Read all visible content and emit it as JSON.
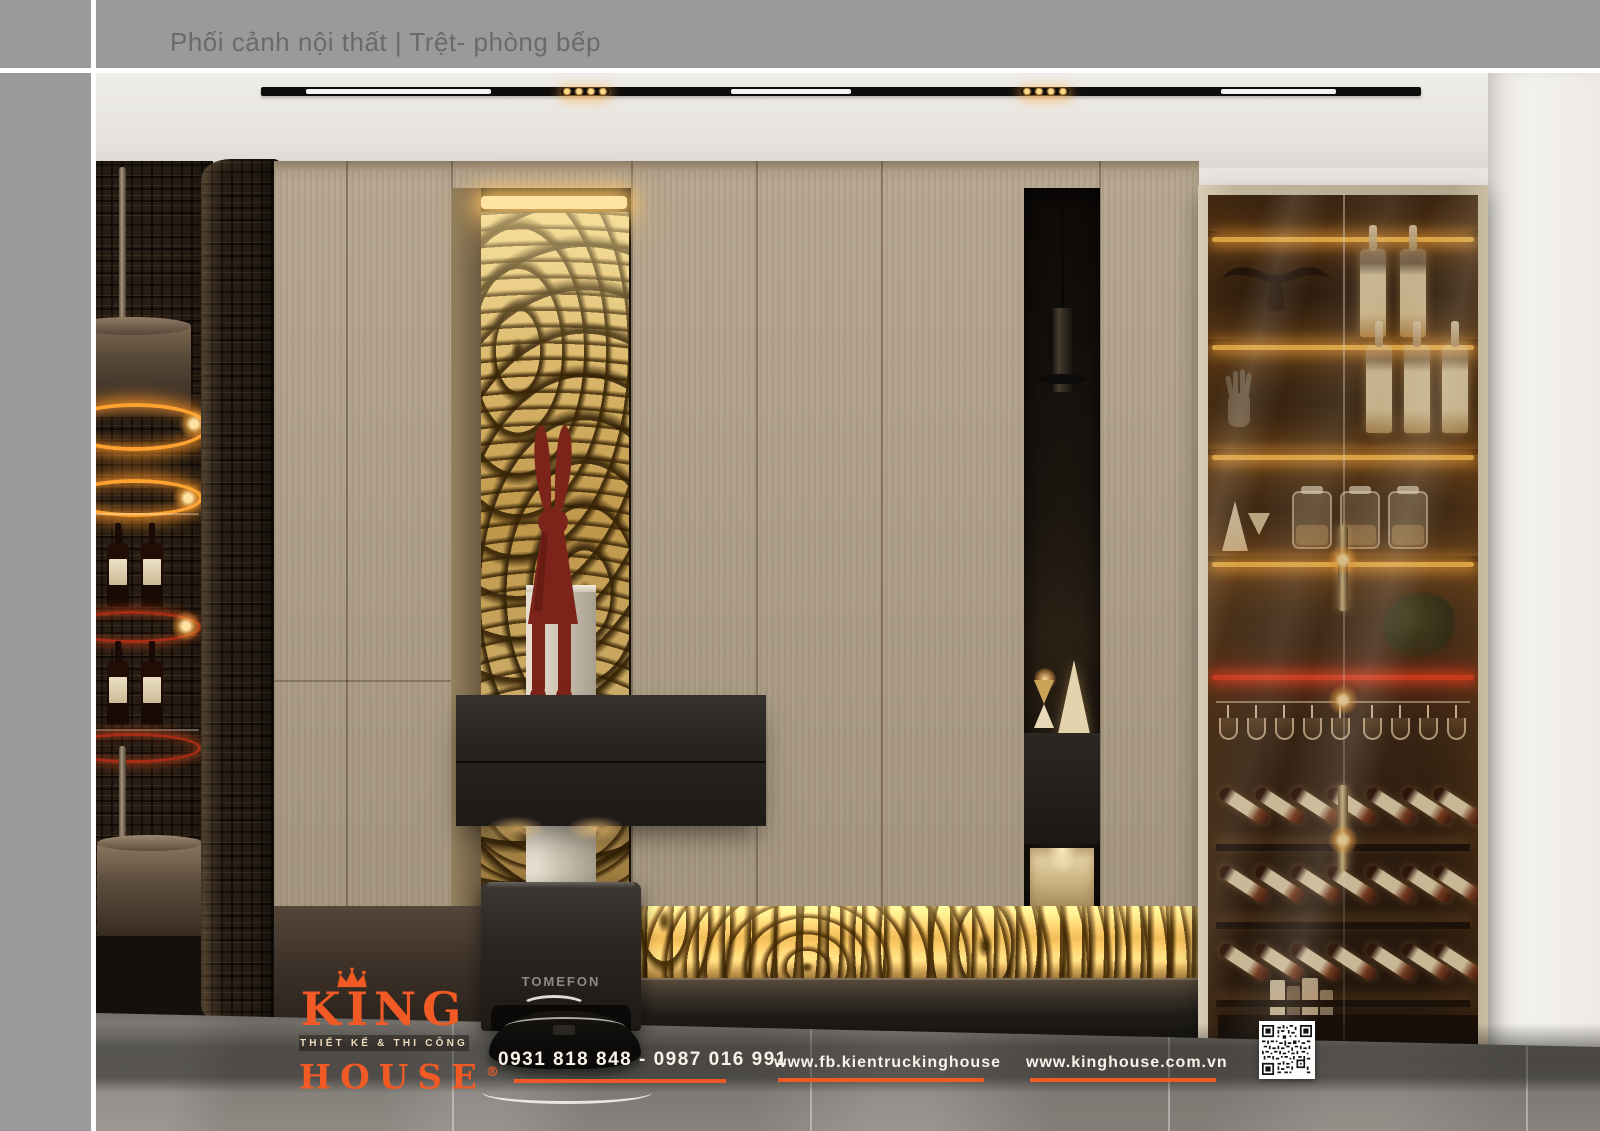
{
  "header": {
    "title": "Phối cảnh nội thất | Trệt- phòng bếp"
  },
  "scene": {
    "vacuum_label": "TOMEFON"
  },
  "branding": {
    "name_top": "KING",
    "tagline": "THIẾT KẾ & THI CÔNG",
    "name_bottom": "HOUSE",
    "registered_mark": "®"
  },
  "contact": {
    "phone": "0931 818 848 - 0987 016 991",
    "facebook": "www.fb.kientruckinghouse",
    "website": "www.kinghouse.com.vn"
  },
  "colors": {
    "brand_orange": "#F15A24",
    "panel_gray": "#9B9A98",
    "title_gray": "#6B6A68",
    "led_amber": "#FFAE3C",
    "led_red": "#E8401F",
    "cabinet_wood": "#AFA089",
    "gold_burl": "#D9B768",
    "floor_gray": "#8B8781"
  },
  "icons": {
    "crown": "crown-icon",
    "qr": "qr-code-icon",
    "rabbit": "rabbit-figurine-icon",
    "longhorn": "longhorn-sculpture-icon",
    "hand": "hand-sculpture-icon"
  }
}
